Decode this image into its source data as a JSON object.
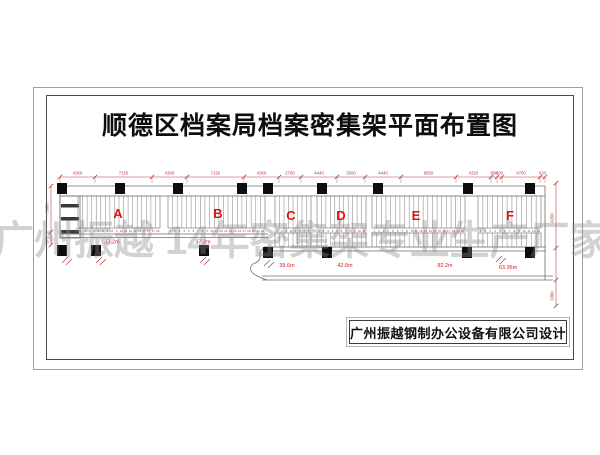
{
  "page": {
    "title": "顺德区档案局档案密集架平面布置图",
    "watermark": "广州振越 14年密集架专业生产厂家",
    "designer": "广州振越钢制办公设备有限公司设计"
  },
  "plan": {
    "sections": [
      {
        "label": "A",
        "length": "37.2m",
        "units": 18
      },
      {
        "label": "B",
        "length": "37.2m",
        "units": 21
      },
      {
        "label": "C",
        "length": "39.6m",
        "units": 8
      },
      {
        "label": "D",
        "length": "42.6m",
        "units": 11
      },
      {
        "label": "E",
        "length": "82.2m",
        "units": 20
      },
      {
        "label": "F",
        "length": "63.36m",
        "units": 13
      }
    ],
    "top_dimensions": [
      "4360",
      "7150",
      "4360",
      "7150",
      "4360",
      "2790",
      "4440",
      "3500",
      "4440",
      "6850",
      "4320",
      "800",
      "600",
      "4750",
      "620"
    ],
    "left_dimensions": [
      "5980",
      "870"
    ],
    "right_dimensions": [
      "4200",
      "1880"
    ],
    "colors": {
      "dim_red": "#b94040",
      "label_red": "#e01212",
      "line_gray": "#6d6d6d",
      "shelf_gray": "#8a8a8a",
      "column_black": "#0d0d0d"
    }
  }
}
